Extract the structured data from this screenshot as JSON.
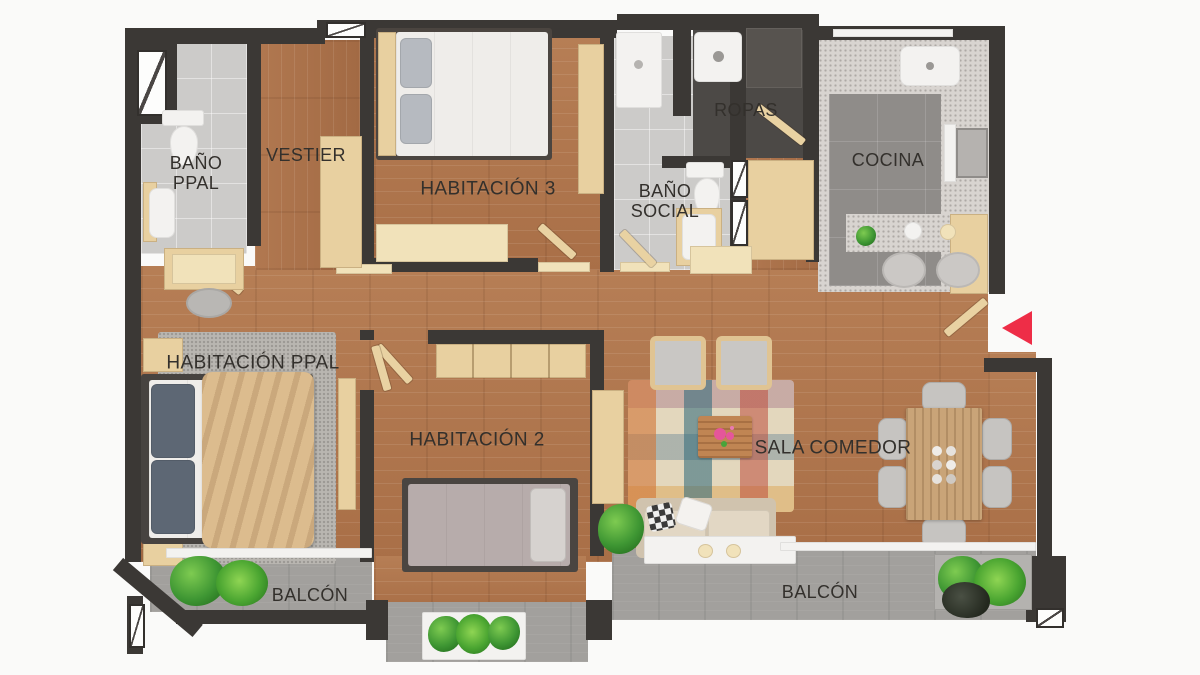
{
  "rooms": {
    "bano_ppal": {
      "label": "BAÑO PPAL"
    },
    "vestier": {
      "label": "VESTIER"
    },
    "habitacion_3": {
      "label": "HABITACIÓN 3"
    },
    "bano_social": {
      "label": "BAÑO SOCIAL"
    },
    "ropas": {
      "label": "ROPAS"
    },
    "cocina": {
      "label": "COCINA"
    },
    "habitacion_ppal": {
      "label": "HABITACIÓN PPAL"
    },
    "habitacion_2": {
      "label": "HABITACIÓN 2"
    },
    "sala_comedor": {
      "label": "SALA COMEDOR"
    },
    "balcon_izq": {
      "label": "BALCÓN"
    },
    "balcon_der": {
      "label": "BALCÓN"
    }
  },
  "colors": {
    "wall": "#3b3835",
    "wood_floor": "#b1794f",
    "bath_tile": "#cccbc9",
    "kitchen_floor": "#8f8c89",
    "balcony_floor": "#a2a09d",
    "furniture_wood": "#e8d0a0",
    "label_text": "#33302c",
    "entry_arrow": "#ee2d47"
  }
}
